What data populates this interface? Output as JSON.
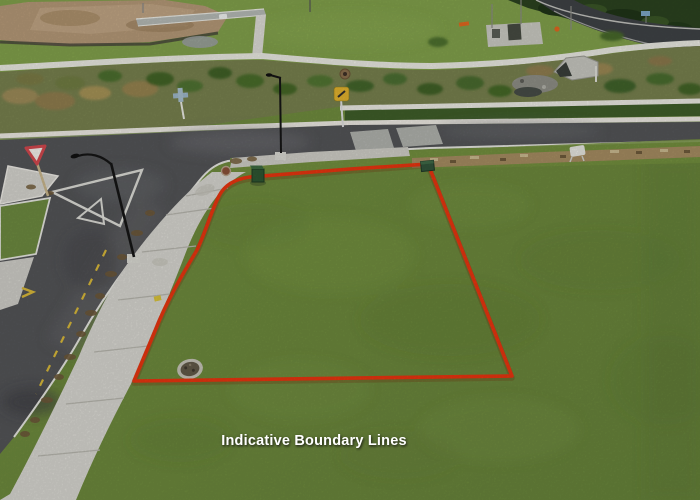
{
  "image": {
    "width": 700,
    "height": 500,
    "kind": "aerial-drone-photograph",
    "subject": "vacant-residential-section-with-roads"
  },
  "annotation": {
    "label": "Indicative Boundary Lines",
    "label_color": "#ffffff",
    "boundary_color": "#e8350f",
    "boundary_shadow": "#7a1a00"
  },
  "scene": {
    "features": [
      "property-lot-grass",
      "boundary-overlay",
      "front-footpath",
      "side-road",
      "cross-road",
      "give-way-sign",
      "give-way-road-marking",
      "street-light",
      "street-light-2",
      "yellow-warning-sign",
      "path-marker-sign",
      "utility-box-left",
      "utility-box-right",
      "manhole-cover",
      "footpath-manhole",
      "planted-bank",
      "retaining-wall",
      "dirt-earthworks",
      "culvert-headwall",
      "construction-pad",
      "traffic-cones",
      "trees-top-right",
      "gravel-drain-strip",
      "no-stopping-yellow-dashes"
    ],
    "palette": {
      "lot_grass": "#6e8a3c",
      "grass_light": "#84a14c",
      "grass_top": "#81a04b",
      "grass_dark": "#56712e",
      "asphalt": "#58595c",
      "asphalt_dark": "#454547",
      "asphalt_tr": "#3e4245",
      "concrete_path": "#d7d6d0",
      "wall_white": "#ece9e2",
      "kerb_white": "#e6e6e0",
      "dirt": "#b49877",
      "shrub_green": "#46682c",
      "tussock_brown": "#9a8753",
      "gravel": "#a58c61",
      "tree_dark": "#2b421f",
      "sign_yellow": "#e2b22e",
      "sign_red": "#d2484e",
      "sign_blue": "#9db7c9",
      "marking_yellow": "#d9b93a",
      "utility_green": "#2e5632"
    }
  }
}
